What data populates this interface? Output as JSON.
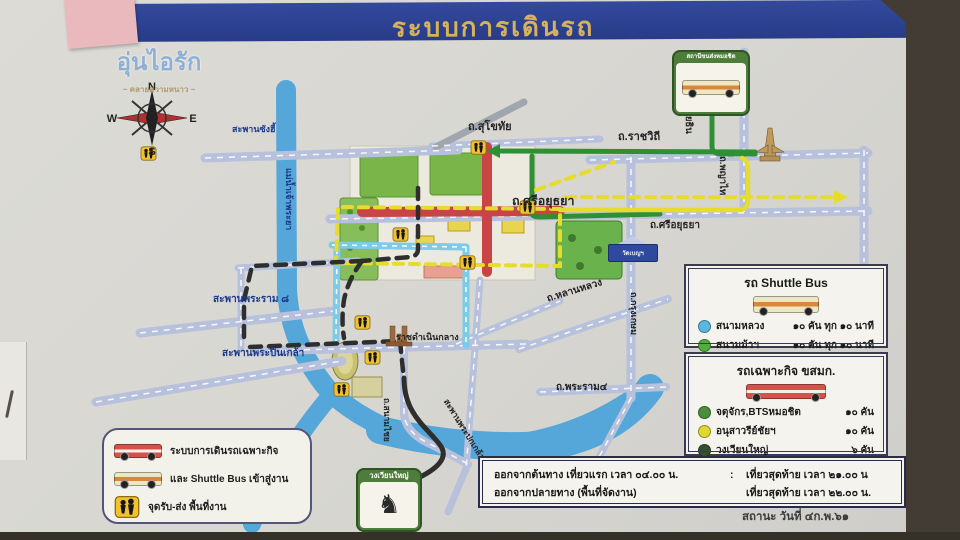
{
  "colors": {
    "header_blue": "#2d4496",
    "title_gold": "#d8b25a",
    "river": "#54a7d8",
    "road": "#b7c1dc",
    "route_green": "#2f8f35",
    "route_yellow": "#e6dc2c",
    "route_red": "#c94545",
    "route_blue": "#7ccbe8",
    "route_black": "#2e2e2e"
  },
  "header": {
    "title": "ระบบการเดินรถ"
  },
  "logo": {
    "name": "อุ่นไอรัก",
    "subtitle": "~ คลายความหนาว ~"
  },
  "compass": {
    "n": "N",
    "e": "E",
    "s": "S",
    "w": "W"
  },
  "map": {
    "labels": [
      {
        "text": "สะพานซังฮี้"
      },
      {
        "text": "แม่น้ำเจ้าพระยา"
      },
      {
        "text": "สะพานพระราม ๘"
      },
      {
        "text": "สะพานพระปิ่นเกล้า"
      },
      {
        "text": "ราชดำเนินกลาง"
      },
      {
        "text": "ถ.สุโขทัย"
      },
      {
        "text": "ถ.ราชวิถี"
      },
      {
        "text": "ถ.พหลโยธิน"
      },
      {
        "text": "ถ.พญาไท"
      },
      {
        "text": "ถ.ศรีอยุธยา"
      },
      {
        "text": "ถ.ศรีอยุธยา"
      },
      {
        "text": "ถ.หลานหลวง"
      },
      {
        "text": "ถ.กรุงเกษม"
      },
      {
        "text": "ถ.พระราม๔"
      },
      {
        "text": "ถ.สนามไชย"
      },
      {
        "text": "สะพานพระปกเกล้า"
      }
    ]
  },
  "landmarks": {
    "mochit": "สถานีขนส่งหมอชิต",
    "wongwian_yai": "วงเวียนใหญ่",
    "temple_sign": "วัดเบญฯ"
  },
  "legend_shuttle": {
    "title": "รถ Shuttle Bus",
    "rows": [
      {
        "place": "สนามหลวง",
        "detail": "๑๐ คัน ทุก ๑๐ นาที",
        "color": "#5bb7e0"
      },
      {
        "place": "สนามม้าฯ",
        "detail": "๑๐ คัน ทุก ๑๐ นาที",
        "color": "#4fae3d"
      }
    ]
  },
  "legend_bmta": {
    "title": "รถเฉพาะกิจ ขสมก.",
    "rows": [
      {
        "place": "จตุจักร,BTSหมอชิต",
        "detail": "๑๐ คัน",
        "color": "#4a8f3c"
      },
      {
        "place": "อนุสาวรีย์ชัยฯ",
        "detail": "๑๐ คัน",
        "color": "#e0d832"
      },
      {
        "place": "วงเวียนใหญ่",
        "detail": "๖ คัน",
        "color": "#33512f"
      }
    ]
  },
  "legend_routes": {
    "row1": "ระบบการเดินรถเฉพาะกิจ",
    "row2": "และ Shuttle Bus เข้าสู่งาน",
    "row3": "จุดรับ-ส่ง พื้นที่งาน"
  },
  "schedule": {
    "line1_left": "ออกจากต้นทาง เที่ยวแรก เวลา ๐๔.๐๐ น.",
    "separator": ":",
    "line1_right": "เที่ยวสุดท้าย เวลา ๒๑.๐๐ น",
    "line2_left": "ออกจากปลายทาง (พื้นที่จัดงาน)",
    "line2_right": "เที่ยวสุดท้าย เวลา ๒๒.๐๐ น."
  },
  "footer": {
    "status": "สถานะ วันที่ ๔ก.พ.๖๑"
  }
}
